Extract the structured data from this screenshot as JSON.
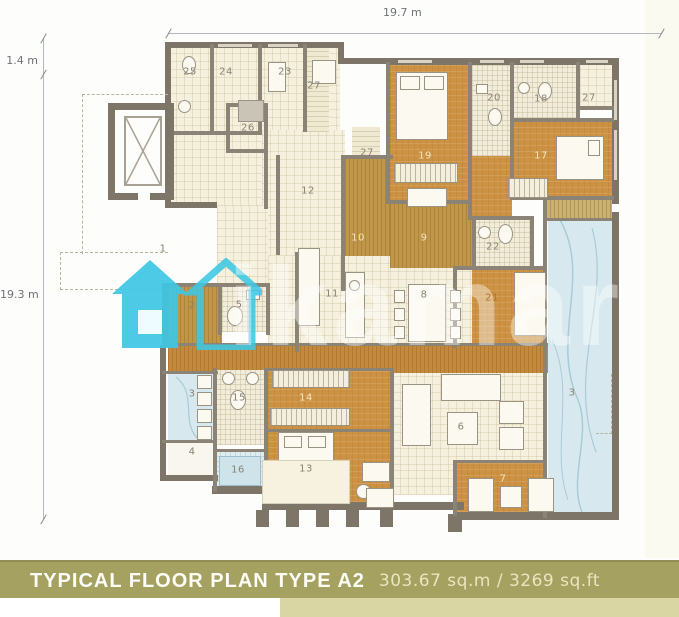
{
  "dimensions": {
    "top": "19.7 m",
    "left_upper": "1.4 m",
    "left_lower": "19.3 m"
  },
  "footer": {
    "title": "TYPICAL FLOOR PLAN TYPE A2",
    "area": "303.67 sq.m / 3269 sq.ft"
  },
  "watermark": {
    "text": "ikamar"
  },
  "colors": {
    "wall": "#7d7668",
    "room_orange": "#cc9142",
    "corridor_tan": "#c09648",
    "tile_cream": "#f6f1de",
    "water_blue": "#d7e9ee",
    "watermark_cyan": "#3ec7e4",
    "footer_olive": "#a5a161",
    "footer_pale": "#d9d6a4"
  },
  "plan": {
    "rooms": [
      {
        "n": "1",
        "x": 163,
        "y": 249,
        "tone": "dark"
      },
      {
        "n": "2",
        "x": 192,
        "y": 306,
        "tone": "dark"
      },
      {
        "n": "3",
        "x": 192,
        "y": 394,
        "tone": "dark"
      },
      {
        "n": "4",
        "x": 192,
        "y": 452,
        "tone": "dark"
      },
      {
        "n": "5",
        "x": 239,
        "y": 305,
        "tone": "dark"
      },
      {
        "n": "6",
        "x": 461,
        "y": 427,
        "tone": "dark"
      },
      {
        "n": "7",
        "x": 503,
        "y": 479,
        "tone": "light"
      },
      {
        "n": "8",
        "x": 424,
        "y": 295,
        "tone": "dark"
      },
      {
        "n": "9",
        "x": 424,
        "y": 238,
        "tone": "light"
      },
      {
        "n": "10",
        "x": 358,
        "y": 238,
        "tone": "light"
      },
      {
        "n": "11",
        "x": 332,
        "y": 294,
        "tone": "dark"
      },
      {
        "n": "12",
        "x": 308,
        "y": 191,
        "tone": "dark"
      },
      {
        "n": "13",
        "x": 306,
        "y": 469,
        "tone": "dark"
      },
      {
        "n": "14",
        "x": 306,
        "y": 398,
        "tone": "light"
      },
      {
        "n": "15",
        "x": 239,
        "y": 398,
        "tone": "dark"
      },
      {
        "n": "16",
        "x": 238,
        "y": 470,
        "tone": "dark"
      },
      {
        "n": "17",
        "x": 541,
        "y": 156,
        "tone": "light"
      },
      {
        "n": "18",
        "x": 541,
        "y": 99,
        "tone": "dark"
      },
      {
        "n": "19",
        "x": 425,
        "y": 156,
        "tone": "light"
      },
      {
        "n": "20",
        "x": 494,
        "y": 98,
        "tone": "dark"
      },
      {
        "n": "21",
        "x": 492,
        "y": 298,
        "tone": "mid"
      },
      {
        "n": "22",
        "x": 493,
        "y": 247,
        "tone": "dark"
      },
      {
        "n": "23",
        "x": 285,
        "y": 72,
        "tone": "dark"
      },
      {
        "n": "24",
        "x": 226,
        "y": 72,
        "tone": "dark"
      },
      {
        "n": "25",
        "x": 190,
        "y": 72,
        "tone": "dark"
      },
      {
        "n": "26",
        "x": 248,
        "y": 128,
        "tone": "dark"
      },
      {
        "n": "27",
        "x": 314,
        "y": 86,
        "tone": "dark"
      },
      {
        "n": "27",
        "x": 367,
        "y": 153,
        "tone": "dark"
      },
      {
        "n": "27",
        "x": 589,
        "y": 98,
        "tone": "dark"
      },
      {
        "n": "3",
        "x": 572,
        "y": 393,
        "tone": "dark"
      }
    ]
  }
}
